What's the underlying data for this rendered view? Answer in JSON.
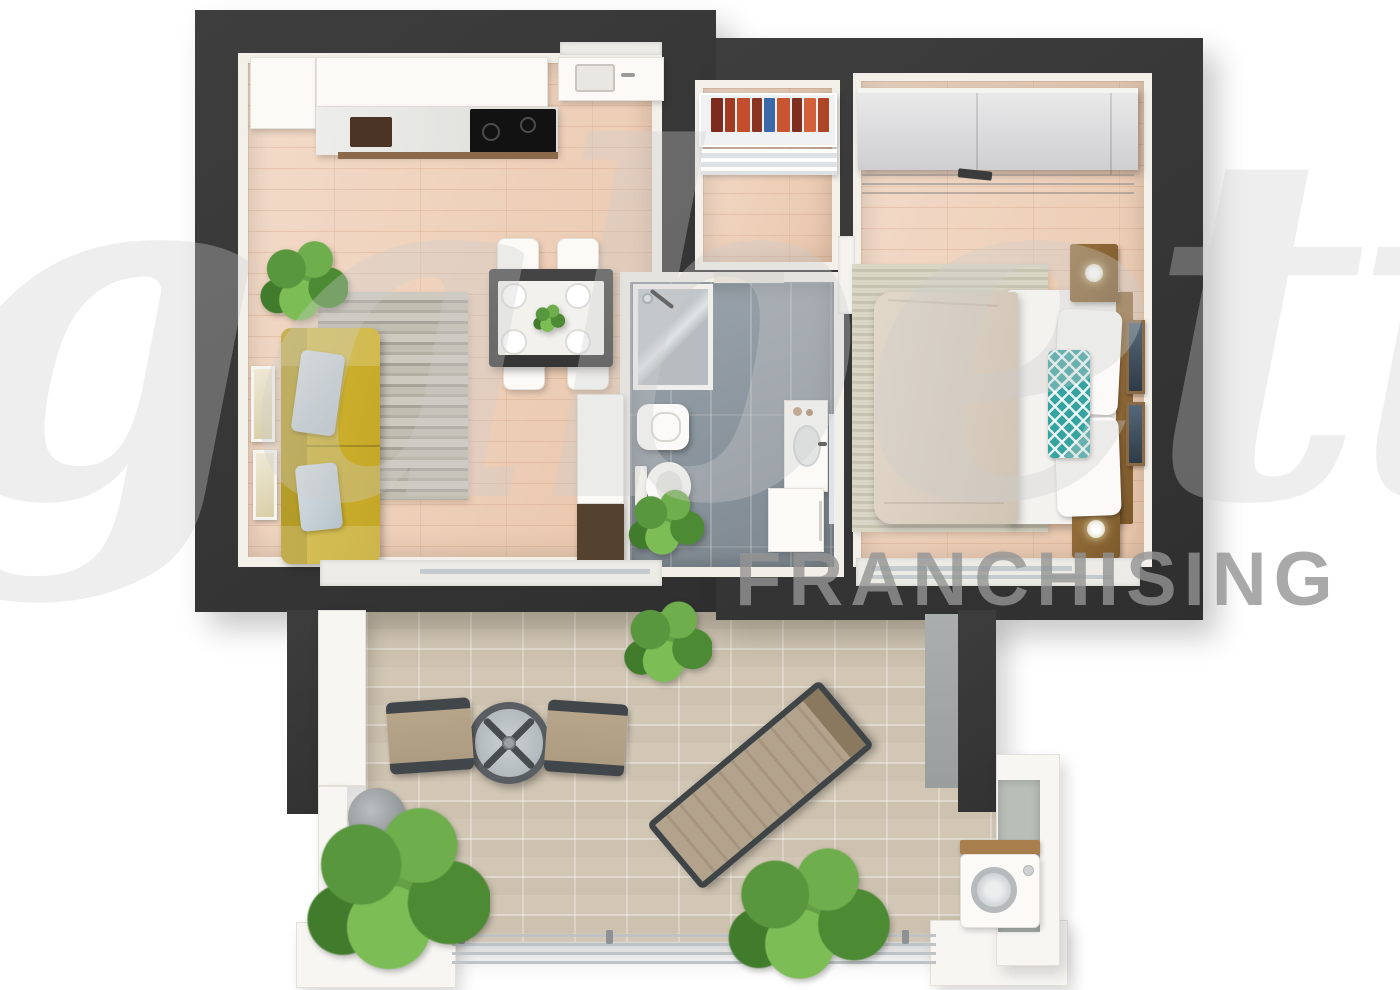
{
  "watermark": {
    "script_text": "gabetti",
    "caption_text": "FRANCHISING"
  },
  "palette": {
    "wall_dark": "#363636",
    "inner_wall_white": "#f3f0ea",
    "wood_floor": "#eeceb5",
    "bathroom_tile": "#8c97a0",
    "terrace_tile": "#d2c7b5",
    "sofa_yellow": "#c9ae2d",
    "pillow_blue": "#c3cdd4",
    "accent_teal": "#35a39f",
    "duvet_beige": "#d9cec0",
    "nightstand_wood": "#8a6233",
    "plant_green": "#5d9c43",
    "watermark_gray": "#949494"
  }
}
